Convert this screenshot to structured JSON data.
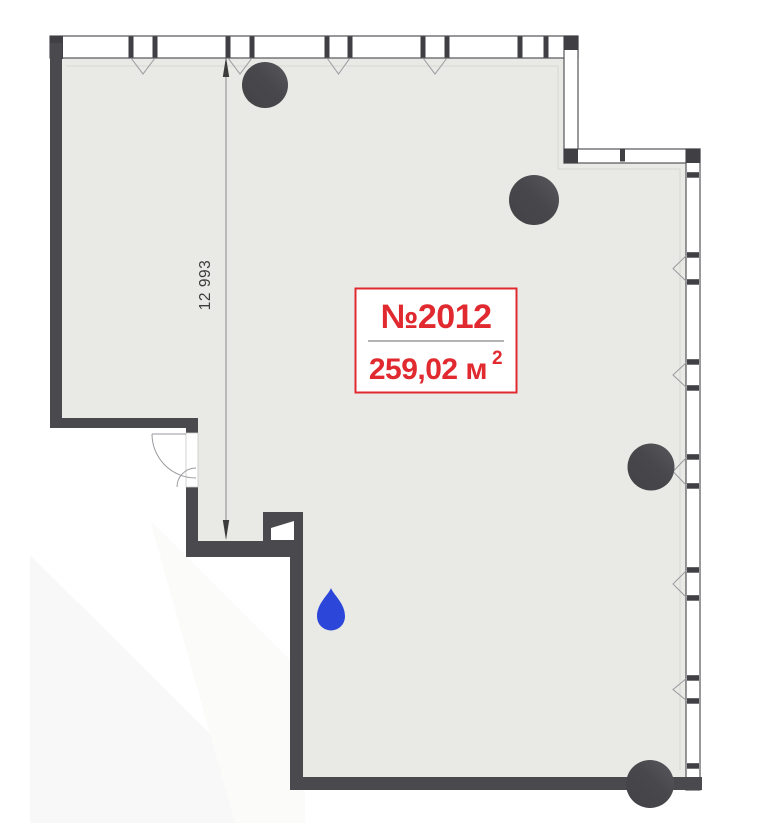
{
  "plan": {
    "unit_badge": {
      "number": "№2012",
      "area_main": "259,02 м",
      "area_sup": "2"
    },
    "dimension": {
      "vertical_label": "12 993"
    },
    "colors": {
      "wall": "#4a4a4e",
      "wall_dark": "#3f3f44",
      "floor": "#e9e9e5",
      "accent_red": "#e12a30",
      "divider_gray": "#9a9a9a",
      "water_blue": "#2b46d9",
      "dim_line": "#8a8a8a",
      "dim_text": "#3c3c3c",
      "frame_line": "#55555a",
      "opening_line": "#9a9aa0",
      "inset_line": "#d7d7d3",
      "watermark": "#f8f8f8",
      "badge_bg": "#ffffff"
    },
    "icons": {
      "column": "column-icon",
      "water": "water-drop-icon"
    }
  }
}
